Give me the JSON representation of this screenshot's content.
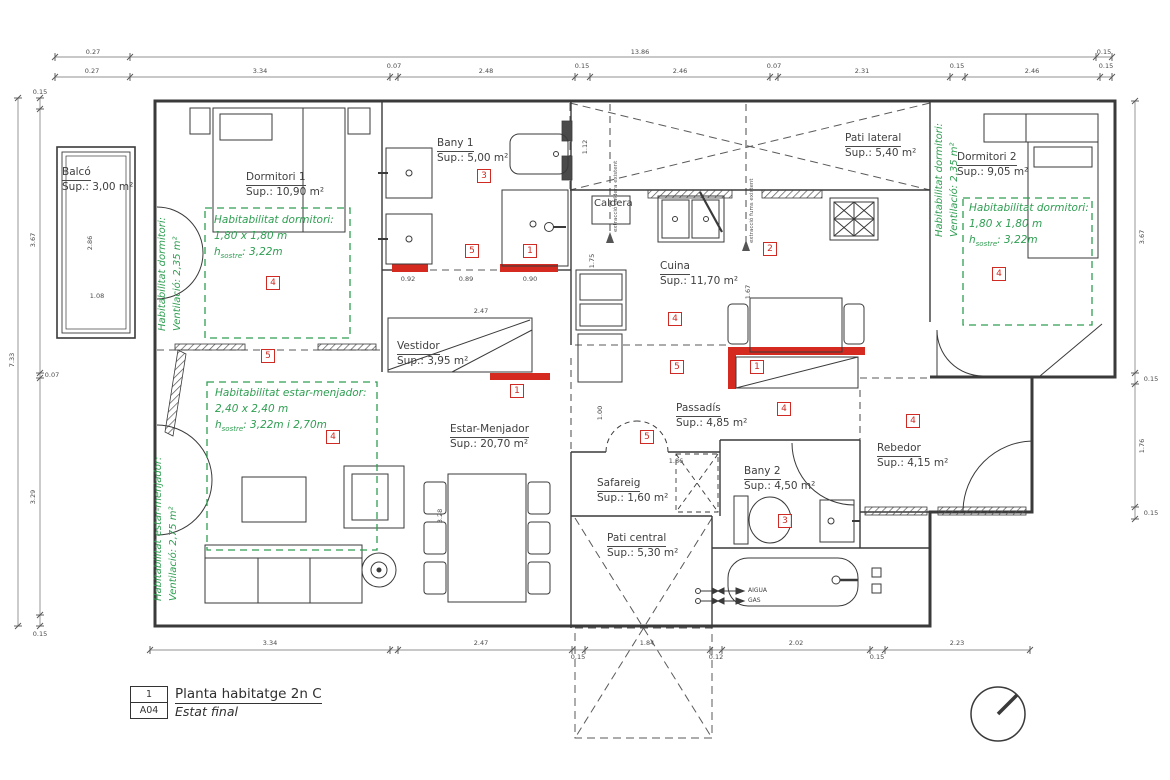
{
  "colors": {
    "line": "#3a3a3a",
    "green": "#2f9e52",
    "red": "#cf2b24",
    "red_wall": "#d42a20"
  },
  "title_block": {
    "detail_number": "1",
    "sheet": "A04",
    "title": "Planta habitatge 2n C",
    "subtitle": "Estat final"
  },
  "rooms": [
    {
      "id": "balco",
      "name": "Balcó",
      "area": "Sup.: 3,00 m²",
      "x": 62,
      "y": 166
    },
    {
      "id": "dormitori-1",
      "name": "Dormitori 1",
      "area": "Sup.: 10,90 m²",
      "x": 246,
      "y": 171
    },
    {
      "id": "bany-1",
      "name": "Bany 1",
      "area": "Sup.: 5,00 m²",
      "x": 437,
      "y": 137
    },
    {
      "id": "pati-lateral",
      "name": "Pati lateral",
      "area": "Sup.: 5,40 m²",
      "x": 845,
      "y": 132
    },
    {
      "id": "dormitori-2",
      "name": "Dormitori 2",
      "area": "Sup.: 9,05 m²",
      "x": 957,
      "y": 151
    },
    {
      "id": "cuina",
      "name": "Cuina",
      "area": "Sup.: 11,70 m²",
      "x": 660,
      "y": 260
    },
    {
      "id": "vestidor",
      "name": "Vestidor",
      "area": "Sup.: 3,95 m²",
      "x": 397,
      "y": 340
    },
    {
      "id": "estar-menjador",
      "name": "Estar-Menjador",
      "area": "Sup.: 20,70 m²",
      "x": 450,
      "y": 423
    },
    {
      "id": "passadis",
      "name": "Passadís",
      "area": "Sup.: 4,85 m²",
      "x": 676,
      "y": 402
    },
    {
      "id": "safareig",
      "name": "Safareig",
      "area": "Sup.: 1,60 m²",
      "x": 597,
      "y": 477
    },
    {
      "id": "bany-2",
      "name": "Bany 2",
      "area": "Sup.: 4,50 m²",
      "x": 744,
      "y": 465
    },
    {
      "id": "rebedor",
      "name": "Rebedor",
      "area": "Sup.: 4,15 m²",
      "x": 877,
      "y": 442
    },
    {
      "id": "pati-central",
      "name": "Pati central",
      "area": "Sup.: 5,30 m²",
      "x": 607,
      "y": 532
    }
  ],
  "hab_notes": [
    {
      "id": "dormitori-1",
      "x": 214,
      "y": 213,
      "line1": "Habitabilitat dormitori:",
      "line2": "1,80 x 1,80 m",
      "h_base": "h",
      "h_sub": "sostre",
      "h_rest": ": 3,22m"
    },
    {
      "id": "estar-menjador",
      "x": 215,
      "y": 386,
      "line1": "Habitabilitat estar-menjador:",
      "line2": "2,40 x 2,40 m",
      "h_base": "h",
      "h_sub": "sostre",
      "h_rest": ": 3,22m i 2,70m"
    },
    {
      "id": "dormitori-2",
      "x": 969,
      "y": 201,
      "line1": "Habitabilitat dormitori:",
      "line2": "1,80 x 1,80 m",
      "h_base": "h",
      "h_sub": "sostre",
      "h_rest": ": 3,22m"
    }
  ],
  "vertical_notes": [
    {
      "id": "dormitori-1",
      "x": 156,
      "y": 331,
      "line1": "Habitabilitat dormitori:",
      "line2": "Ventilació: 2,35 m²"
    },
    {
      "id": "estar-menjador",
      "x": 152,
      "y": 601,
      "line1": "Habitabilitat estar-menjador:",
      "line2": "Ventilació: 2,75 m²"
    },
    {
      "id": "dormitori-2",
      "x": 933,
      "y": 237,
      "line1": "Habitabilitat dormitori:",
      "line2": "Ventilació: 2,35 m²"
    }
  ],
  "markers": [
    {
      "n": "3",
      "x": 484,
      "y": 176
    },
    {
      "n": "5",
      "x": 472,
      "y": 251
    },
    {
      "n": "1",
      "x": 530,
      "y": 251
    },
    {
      "n": "2",
      "x": 770,
      "y": 249
    },
    {
      "n": "4",
      "x": 273,
      "y": 283
    },
    {
      "n": "5",
      "x": 268,
      "y": 356
    },
    {
      "n": "4",
      "x": 333,
      "y": 437
    },
    {
      "n": "1",
      "x": 517,
      "y": 391
    },
    {
      "n": "4",
      "x": 675,
      "y": 319
    },
    {
      "n": "5",
      "x": 677,
      "y": 367
    },
    {
      "n": "1",
      "x": 757,
      "y": 367
    },
    {
      "n": "4",
      "x": 999,
      "y": 274
    },
    {
      "n": "5",
      "x": 647,
      "y": 437
    },
    {
      "n": "4",
      "x": 784,
      "y": 409
    },
    {
      "n": "4",
      "x": 913,
      "y": 421
    },
    {
      "n": "3",
      "x": 785,
      "y": 521
    }
  ],
  "annotations": [
    {
      "id": "caldera-label",
      "text": "Caldera",
      "x": 594,
      "y": 198,
      "fs": 10
    },
    {
      "id": "aigua-label",
      "text": "AIGUA",
      "x": 748,
      "y": 587,
      "fs": 6
    },
    {
      "id": "gas-label",
      "text": "GAS",
      "x": 748,
      "y": 597,
      "fs": 6
    },
    {
      "id": "extraccio-caldera-label",
      "text": "extracció caldera existent",
      "x": 613,
      "y": 232,
      "r": 1,
      "fs": 5.5
    },
    {
      "id": "extraccio-fums-label",
      "text": "extracció fums existent",
      "x": 749,
      "y": 243,
      "r": 1,
      "fs": 5.5
    }
  ],
  "dim_labels": [
    {
      "t": "0.27",
      "x": 93,
      "y": 52
    },
    {
      "t": "13.86",
      "x": 640,
      "y": 52
    },
    {
      "t": "0.15",
      "x": 1104,
      "y": 52
    },
    {
      "t": "0.27",
      "x": 92,
      "y": 71
    },
    {
      "t": "3.34",
      "x": 260,
      "y": 71
    },
    {
      "t": "0.07",
      "x": 394,
      "y": 66
    },
    {
      "t": "2.48",
      "x": 486,
      "y": 71
    },
    {
      "t": "0.15",
      "x": 582,
      "y": 66
    },
    {
      "t": "2.46",
      "x": 680,
      "y": 71
    },
    {
      "t": "0.07",
      "x": 774,
      "y": 66
    },
    {
      "t": "2.31",
      "x": 862,
      "y": 71
    },
    {
      "t": "0.15",
      "x": 957,
      "y": 66
    },
    {
      "t": "2.46",
      "x": 1032,
      "y": 71
    },
    {
      "t": "0.15",
      "x": 1106,
      "y": 66
    },
    {
      "t": "3.34",
      "x": 270,
      "y": 643
    },
    {
      "t": "2.47",
      "x": 481,
      "y": 643
    },
    {
      "t": "0.15",
      "x": 578,
      "y": 657
    },
    {
      "t": "1.84",
      "x": 647,
      "y": 643
    },
    {
      "t": "0.12",
      "x": 716,
      "y": 657
    },
    {
      "t": "2.02",
      "x": 796,
      "y": 643
    },
    {
      "t": "0.15",
      "x": 877,
      "y": 657
    },
    {
      "t": "2.23",
      "x": 957,
      "y": 643
    },
    {
      "t": "7.33",
      "x": 12,
      "y": 360,
      "r": 1
    },
    {
      "t": "0.15",
      "x": 40,
      "y": 92
    },
    {
      "t": "3.67",
      "x": 33,
      "y": 240,
      "r": 1
    },
    {
      "t": "0.07",
      "x": 52,
      "y": 375
    },
    {
      "t": "3.29",
      "x": 33,
      "y": 497,
      "r": 1
    },
    {
      "t": "0.15",
      "x": 40,
      "y": 634
    },
    {
      "t": "3.67",
      "x": 1142,
      "y": 237,
      "r": 1
    },
    {
      "t": "0.15",
      "x": 1151,
      "y": 379
    },
    {
      "t": "1.76",
      "x": 1142,
      "y": 446,
      "r": 1
    },
    {
      "t": "0.15",
      "x": 1151,
      "y": 513
    },
    {
      "t": "2.86",
      "x": 90,
      "y": 243,
      "r": 1
    },
    {
      "t": "1.08",
      "x": 97,
      "y": 296
    },
    {
      "t": "0.92",
      "x": 408,
      "y": 279
    },
    {
      "t": "0.89",
      "x": 466,
      "y": 279
    },
    {
      "t": "0.90",
      "x": 530,
      "y": 279
    },
    {
      "t": "2.47",
      "x": 481,
      "y": 311
    },
    {
      "t": "1.12",
      "x": 585,
      "y": 147,
      "r": 1
    },
    {
      "t": "1.75",
      "x": 592,
      "y": 261,
      "r": 1
    },
    {
      "t": "1.67",
      "x": 748,
      "y": 292,
      "r": 1
    },
    {
      "t": "1.86",
      "x": 676,
      "y": 461
    },
    {
      "t": "1.00",
      "x": 600,
      "y": 413,
      "r": 1
    },
    {
      "t": "3.28",
      "x": 440,
      "y": 516,
      "r": 1
    }
  ]
}
